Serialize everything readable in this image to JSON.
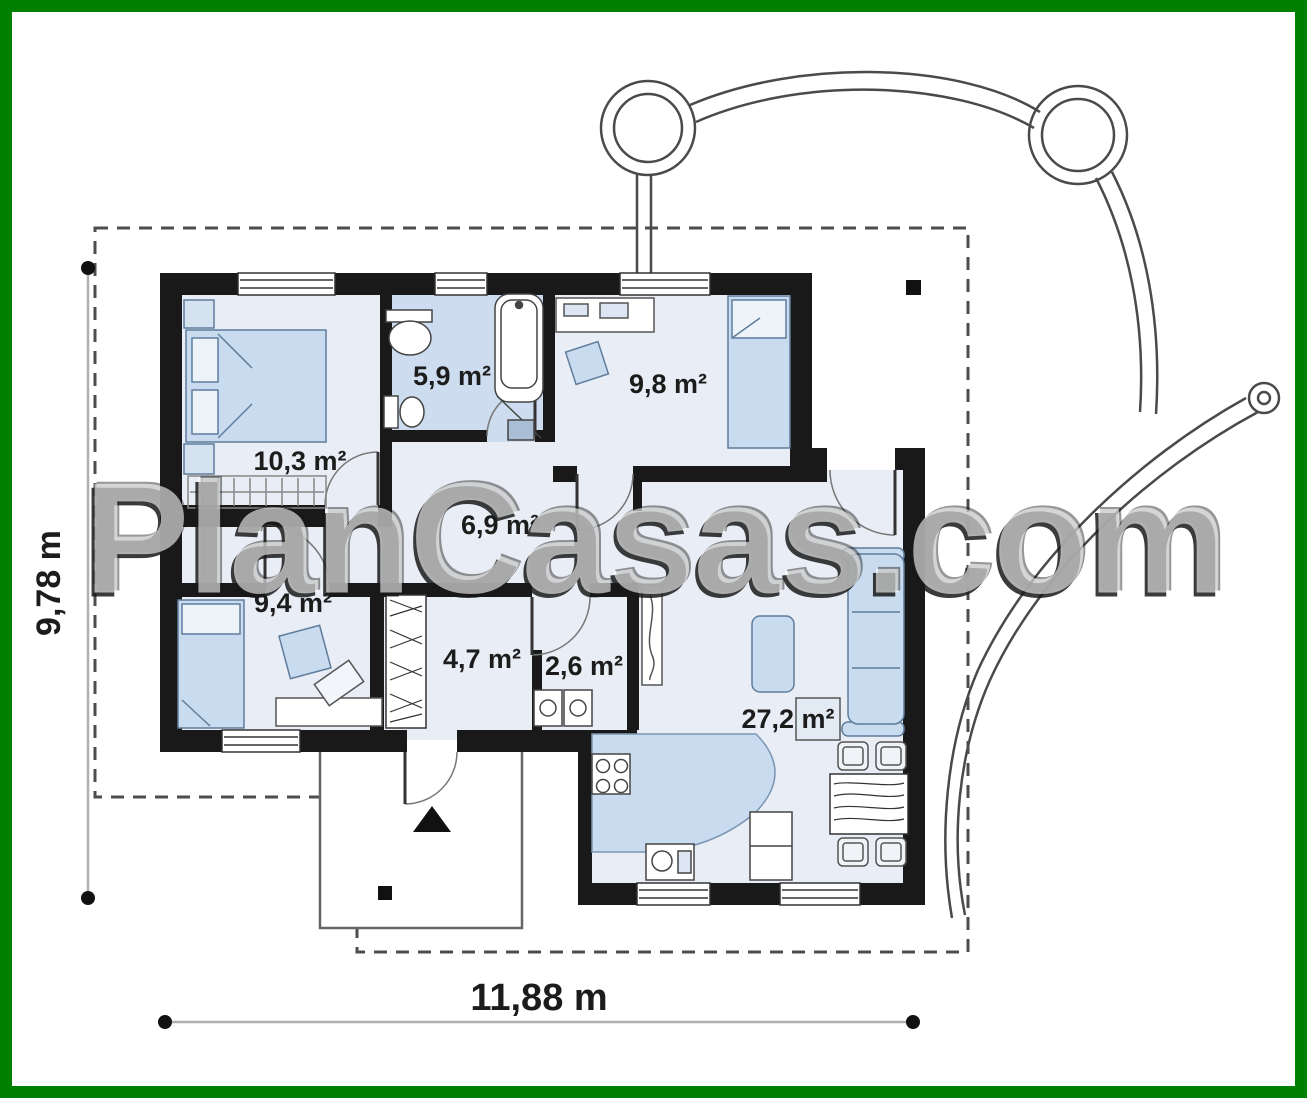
{
  "watermark": {
    "text": "PlanCasas.com"
  },
  "plan": {
    "rooms": [
      {
        "id": "bedroom-1",
        "area": "10,3 m²"
      },
      {
        "id": "bathroom",
        "area": "5,9 m²"
      },
      {
        "id": "bedroom-2",
        "area": "9,8 m²"
      },
      {
        "id": "hallway",
        "area": "6,9 m²"
      },
      {
        "id": "bedroom-3",
        "area": "9,4 m²"
      },
      {
        "id": "entry-hall",
        "area": "4,7 m²"
      },
      {
        "id": "utility",
        "area": "2,6 m²"
      },
      {
        "id": "living-kitchen",
        "area": "27,2 m²"
      }
    ],
    "dimensions": {
      "total_width": "11,88 m",
      "total_depth": "9,78 m"
    }
  },
  "colors": {
    "frame_green": "#008000",
    "wall": "#191919",
    "floor": "#e9edf5",
    "wet_room_floor": "#cdddef",
    "furniture_blue": "#c9dbee"
  }
}
